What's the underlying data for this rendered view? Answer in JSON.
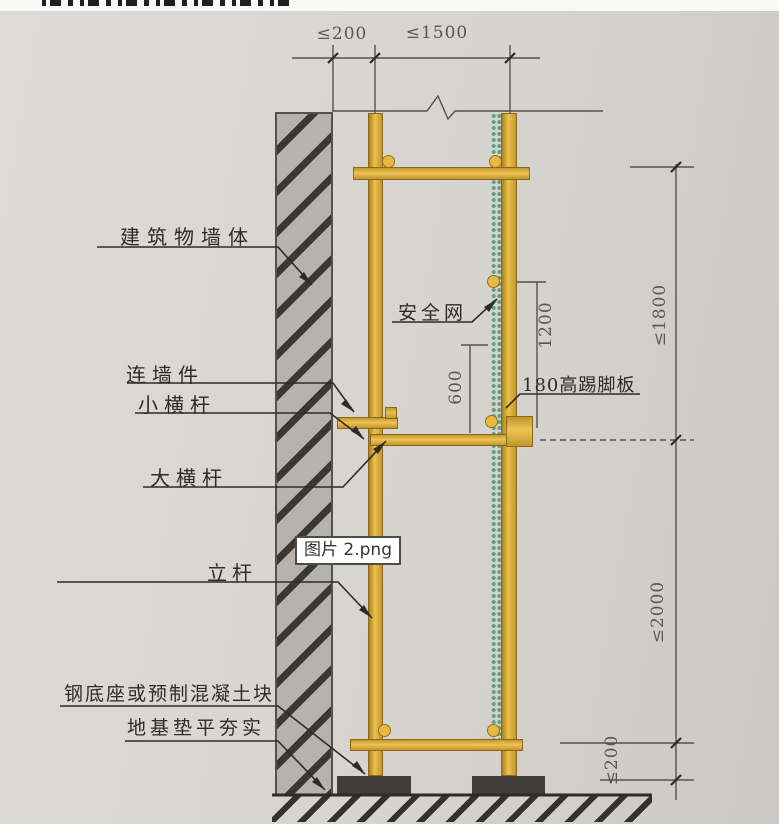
{
  "overlay": {
    "filename": "图片 2.png"
  },
  "diagram": {
    "labels": {
      "building_wall": "建筑物墙体",
      "safety_net": "安全网",
      "wall_tie": "连墙件",
      "small_crossbar": "小横杆",
      "main_ledger": "大横杆",
      "toe_board": "180高踢脚板",
      "standing_pole": "立杆",
      "steel_base": "钢底座或预制混凝土块",
      "foundation": "地基垫平夯实"
    },
    "dimensions": {
      "top_wall_gap": "≤200",
      "top_bay": "≤1500",
      "right_top_lift": "≤1800",
      "right_main_lift": "≤2000",
      "right_bottom_gap": "≤200",
      "guardrail_height": "1200",
      "mid_rail_height": "600"
    },
    "colors": {
      "scaffold_yellow": "#d8a733",
      "safety_net_green": "#5f9f80",
      "wall_gray": "#b6b3ae",
      "base_block_gray": "#3f3e3b",
      "paper": "#d7d4cf",
      "line_dark": "#2e2b26"
    }
  }
}
